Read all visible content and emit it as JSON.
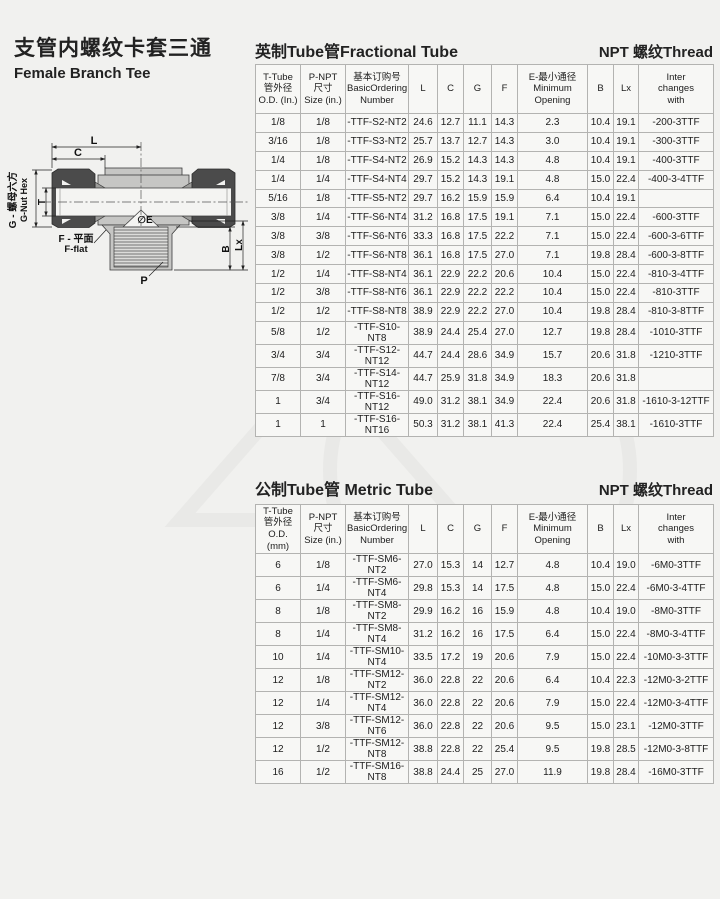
{
  "page": {
    "title_zh": "支管内螺纹卡套三通",
    "title_en": "Female Branch Tee"
  },
  "colors": {
    "nut_dark": "#4b4b4b",
    "body_gray": "#c6c6c4",
    "page_bg": "#f1f1ef"
  },
  "diagram": {
    "labels": {
      "L": "L",
      "C": "C",
      "T": "T",
      "g_zh": "G - 螺母六方",
      "g_en": "G-Nut Hex",
      "e": "∅E",
      "f_zh": "F - 平面",
      "f_en": "F-flat",
      "B": "B",
      "Lx": "Lx",
      "P": "P"
    }
  },
  "sections": {
    "fractional": {
      "title": "英制Tube管Fractional Tube",
      "thread": "NPT 螺纹Thread"
    },
    "metric": {
      "title": "公制Tube管 Metric Tube",
      "thread": "NPT 螺纹Thread"
    }
  },
  "fractional_table": {
    "headers": [
      [
        "T-Tube",
        "管外径",
        "O.D. (In.)"
      ],
      [
        "P-NPT",
        "尺寸",
        "Size (in.)"
      ],
      [
        "基本订购号",
        "BasicOrdering",
        "Number"
      ],
      [
        "L"
      ],
      [
        "C"
      ],
      [
        "G"
      ],
      [
        "F"
      ],
      [
        "E-最小通径",
        "Minimum",
        "Opening"
      ],
      [
        "B"
      ],
      [
        "Lx"
      ],
      [
        "Inter",
        "changes",
        "with"
      ]
    ],
    "rows": [
      [
        "1/8",
        "1/8",
        "-TTF-S2-NT2",
        "24.6",
        "12.7",
        "11.1",
        "14.3",
        "2.3",
        "10.4",
        "19.1",
        "-200-3TTF"
      ],
      [
        "3/16",
        "1/8",
        "-TTF-S3-NT2",
        "25.7",
        "13.7",
        "12.7",
        "14.3",
        "3.0",
        "10.4",
        "19.1",
        "-300-3TTF"
      ],
      [
        "1/4",
        "1/8",
        "-TTF-S4-NT2",
        "26.9",
        "15.2",
        "14.3",
        "14.3",
        "4.8",
        "10.4",
        "19.1",
        "-400-3TTF"
      ],
      [
        "1/4",
        "1/4",
        "-TTF-S4-NT4",
        "29.7",
        "15.2",
        "14.3",
        "19.1",
        "4.8",
        "15.0",
        "22.4",
        "-400-3-4TTF"
      ],
      [
        "5/16",
        "1/8",
        "-TTF-S5-NT2",
        "29.7",
        "16.2",
        "15.9",
        "15.9",
        "6.4",
        "10.4",
        "19.1",
        ""
      ],
      [
        "3/8",
        "1/4",
        "-TTF-S6-NT4",
        "31.2",
        "16.8",
        "17.5",
        "19.1",
        "7.1",
        "15.0",
        "22.4",
        "-600-3TTF"
      ],
      [
        "3/8",
        "3/8",
        "-TTF-S6-NT6",
        "33.3",
        "16.8",
        "17.5",
        "22.2",
        "7.1",
        "15.0",
        "22.4",
        "-600-3-6TTF"
      ],
      [
        "3/8",
        "1/2",
        "-TTF-S6-NT8",
        "36.1",
        "16.8",
        "17.5",
        "27.0",
        "7.1",
        "19.8",
        "28.4",
        "-600-3-8TTF"
      ],
      [
        "1/2",
        "1/4",
        "-TTF-S8-NT4",
        "36.1",
        "22.9",
        "22.2",
        "20.6",
        "10.4",
        "15.0",
        "22.4",
        "-810-3-4TTF"
      ],
      [
        "1/2",
        "3/8",
        "-TTF-S8-NT6",
        "36.1",
        "22.9",
        "22.2",
        "22.2",
        "10.4",
        "15.0",
        "22.4",
        "-810-3TTF"
      ],
      [
        "1/2",
        "1/2",
        "-TTF-S8-NT8",
        "38.9",
        "22.9",
        "22.2",
        "27.0",
        "10.4",
        "19.8",
        "28.4",
        "-810-3-8TTF"
      ],
      [
        "5/8",
        "1/2",
        "-TTF-S10-NT8",
        "38.9",
        "24.4",
        "25.4",
        "27.0",
        "12.7",
        "19.8",
        "28.4",
        "-1010-3TTF"
      ],
      [
        "3/4",
        "3/4",
        "-TTF-S12-NT12",
        "44.7",
        "24.4",
        "28.6",
        "34.9",
        "15.7",
        "20.6",
        "31.8",
        "-1210-3TTF"
      ],
      [
        "7/8",
        "3/4",
        "-TTF-S14-NT12",
        "44.7",
        "25.9",
        "31.8",
        "34.9",
        "18.3",
        "20.6",
        "31.8",
        ""
      ],
      [
        "1",
        "3/4",
        "-TTF-S16-NT12",
        "49.0",
        "31.2",
        "38.1",
        "34.9",
        "22.4",
        "20.6",
        "31.8",
        "-1610-3-12TTF"
      ],
      [
        "1",
        "1",
        "-TTF-S16-NT16",
        "50.3",
        "31.2",
        "38.1",
        "41.3",
        "22.4",
        "25.4",
        "38.1",
        "-1610-3TTF"
      ]
    ]
  },
  "metric_table": {
    "headers": [
      [
        "T-Tube",
        "管外径",
        "O.D. (mm)"
      ],
      [
        "P-NPT",
        "尺寸",
        "Size (in.)"
      ],
      [
        "基本订购号",
        "BasicOrdering",
        "Number"
      ],
      [
        "L"
      ],
      [
        "C"
      ],
      [
        "G"
      ],
      [
        "F"
      ],
      [
        "E-最小通径",
        "Minimum",
        "Opening"
      ],
      [
        "B"
      ],
      [
        "Lx"
      ],
      [
        "Inter",
        "changes",
        "with"
      ]
    ],
    "rows": [
      [
        "6",
        "1/8",
        "-TTF-SM6-NT2",
        "27.0",
        "15.3",
        "14",
        "12.7",
        "4.8",
        "10.4",
        "19.0",
        "-6M0-3TTF"
      ],
      [
        "6",
        "1/4",
        "-TTF-SM6-NT4",
        "29.8",
        "15.3",
        "14",
        "17.5",
        "4.8",
        "15.0",
        "22.4",
        "-6M0-3-4TTF"
      ],
      [
        "8",
        "1/8",
        "-TTF-SM8-NT2",
        "29.9",
        "16.2",
        "16",
        "15.9",
        "4.8",
        "10.4",
        "19.0",
        "-8M0-3TTF"
      ],
      [
        "8",
        "1/4",
        "-TTF-SM8-NT4",
        "31.2",
        "16.2",
        "16",
        "17.5",
        "6.4",
        "15.0",
        "22.4",
        "-8M0-3-4TTF"
      ],
      [
        "10",
        "1/4",
        "-TTF-SM10-NT4",
        "33.5",
        "17.2",
        "19",
        "20.6",
        "7.9",
        "15.0",
        "22.4",
        "-10M0-3-3TTF"
      ],
      [
        "12",
        "1/8",
        "-TTF-SM12-NT2",
        "36.0",
        "22.8",
        "22",
        "20.6",
        "6.4",
        "10.4",
        "22.3",
        "-12M0-3-2TTF"
      ],
      [
        "12",
        "1/4",
        "-TTF-SM12-NT4",
        "36.0",
        "22.8",
        "22",
        "20.6",
        "7.9",
        "15.0",
        "22.4",
        "-12M0-3-4TTF"
      ],
      [
        "12",
        "3/8",
        "-TTF-SM12-NT6",
        "36.0",
        "22.8",
        "22",
        "20.6",
        "9.5",
        "15.0",
        "23.1",
        "-12M0-3TTF"
      ],
      [
        "12",
        "1/2",
        "-TTF-SM12-NT8",
        "38.8",
        "22.8",
        "22",
        "25.4",
        "9.5",
        "19.8",
        "28.5",
        "-12M0-3-8TTF"
      ],
      [
        "16",
        "1/2",
        "-TTF-SM16-NT8",
        "38.8",
        "24.4",
        "25",
        "27.0",
        "11.9",
        "19.8",
        "28.4",
        "-16M0-3TTF"
      ]
    ]
  }
}
